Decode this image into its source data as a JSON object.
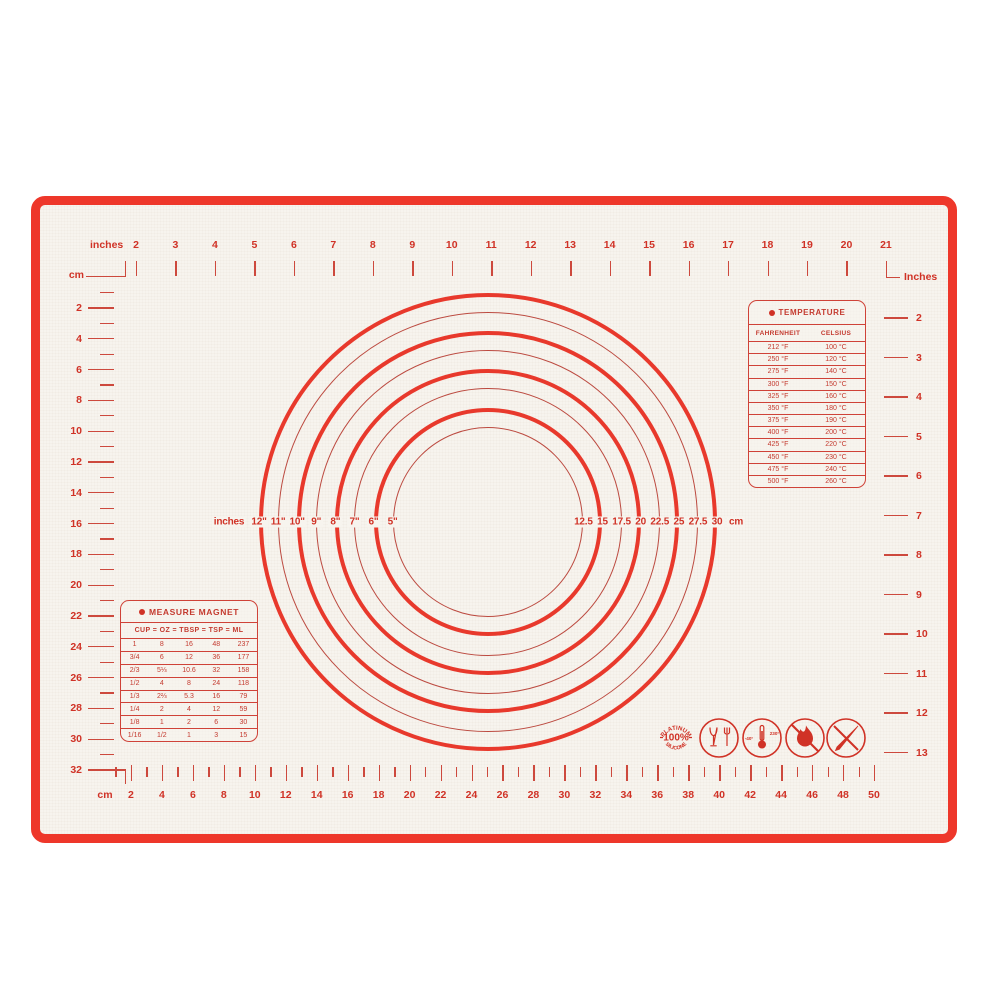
{
  "colors": {
    "border_red": "#ee372a",
    "ring_red_thick": "#e8392c",
    "ring_red_thin": "#bc4a40",
    "text_red": "#d03226",
    "mat_cream": "#f7f4ee"
  },
  "top_ruler": {
    "unit_label": "inches",
    "numbers": [
      2,
      3,
      4,
      5,
      6,
      7,
      8,
      9,
      10,
      11,
      12,
      13,
      14,
      15,
      16,
      17,
      18,
      19,
      20,
      21
    ]
  },
  "left_ruler": {
    "unit_label": "cm",
    "numbers": [
      2,
      4,
      6,
      8,
      10,
      12,
      14,
      16,
      18,
      20,
      22,
      24,
      26,
      28,
      30,
      32
    ]
  },
  "right_ruler": {
    "unit_label": "Inches",
    "numbers": [
      2,
      3,
      4,
      5,
      6,
      7,
      8,
      9,
      10,
      11,
      12,
      13
    ]
  },
  "bottom_ruler": {
    "unit_label": "cm",
    "numbers": [
      2,
      4,
      6,
      8,
      10,
      12,
      14,
      16,
      18,
      20,
      22,
      24,
      26,
      28,
      30,
      32,
      34,
      36,
      38,
      40,
      42,
      44,
      46,
      48,
      50
    ]
  },
  "circles": {
    "left_unit_label": "inches",
    "right_unit_label": "cm",
    "rings": [
      {
        "diameter_in": 12,
        "inches_label": "12\"",
        "cm_label": "30"
      },
      {
        "diameter_in": 11,
        "inches_label": "11\"",
        "cm_label": "27.5"
      },
      {
        "diameter_in": 10,
        "inches_label": "10\"",
        "cm_label": "25"
      },
      {
        "diameter_in": 9,
        "inches_label": "9\"",
        "cm_label": "22.5"
      },
      {
        "diameter_in": 8,
        "inches_label": "8\"",
        "cm_label": "20"
      },
      {
        "diameter_in": 7,
        "inches_label": "7\"",
        "cm_label": "17.5"
      },
      {
        "diameter_in": 6,
        "inches_label": "6\"",
        "cm_label": "15"
      },
      {
        "diameter_in": 5,
        "inches_label": "5\"",
        "cm_label": "12.5"
      }
    ]
  },
  "temperature_table": {
    "title": "TEMPERATURE",
    "columns": [
      "FAHRENHEIT",
      "CELSIUS"
    ],
    "rows": [
      [
        "212 °F",
        "100 °C"
      ],
      [
        "250 °F",
        "120 °C"
      ],
      [
        "275 °F",
        "140 °C"
      ],
      [
        "300 °F",
        "150 °C"
      ],
      [
        "325 °F",
        "160 °C"
      ],
      [
        "350 °F",
        "180 °C"
      ],
      [
        "375 °F",
        "190 °C"
      ],
      [
        "400 °F",
        "200 °C"
      ],
      [
        "425 °F",
        "220 °C"
      ],
      [
        "450 °F",
        "230 °C"
      ],
      [
        "475 °F",
        "240 °C"
      ],
      [
        "500 °F",
        "260 °C"
      ]
    ]
  },
  "measure_table": {
    "title": "MEASURE MAGNET",
    "header": "CUP = OZ = TBSP = TSP = ML",
    "rows": [
      [
        "1",
        "8",
        "16",
        "48",
        "237"
      ],
      [
        "3/4",
        "6",
        "12",
        "36",
        "177"
      ],
      [
        "2/3",
        "5⅓",
        "10.6",
        "32",
        "158"
      ],
      [
        "1/2",
        "4",
        "8",
        "24",
        "118"
      ],
      [
        "1/3",
        "2⅔",
        "5.3",
        "16",
        "79"
      ],
      [
        "1/4",
        "2",
        "4",
        "12",
        "59"
      ],
      [
        "1/8",
        "1",
        "2",
        "6",
        "30"
      ],
      [
        "1/16",
        "1/2",
        "1",
        "3",
        "15"
      ]
    ]
  },
  "icons": {
    "badge": {
      "name": "platinum-silicone-badge",
      "arc_top": "PLATINUM",
      "center": "100%",
      "arc_bottom": "SILICONE"
    },
    "food_safe": {
      "name": "food-safe-glass-fork-icon"
    },
    "temp_range": {
      "name": "temperature-range-icon",
      "min": "-40°",
      "max": "230°"
    },
    "no_flame": {
      "name": "no-open-flame-icon"
    },
    "no_knife": {
      "name": "no-knife-icon"
    }
  }
}
